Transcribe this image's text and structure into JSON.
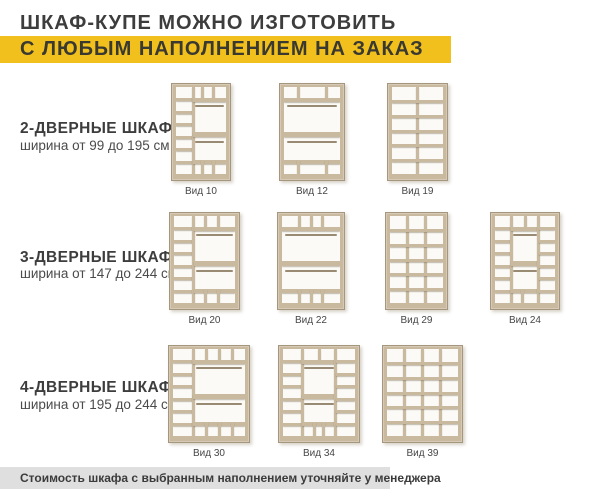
{
  "title": "ШКАФ-КУПЕ МОЖНО ИЗГОТОВИТЬ",
  "banner": "С ЛЮБЫМ НАПОЛНЕНИЕМ НА ЗАКАЗ",
  "footer": "Стоимость шкафа с выбранным наполнением уточняйте у менеджера",
  "colors": {
    "accent_yellow": "#f1c01d",
    "wood": "#c8b99f",
    "wood_edge": "#a5977e",
    "rod": "#998b73",
    "text_dark": "#3d3d3d",
    "footer_bg": "#dfdfdf"
  },
  "sections": [
    {
      "heading": "2-ДВЕРНЫЕ ШКАФЫ",
      "subheading": "ширина от 99 до 195 см",
      "layout": {
        "heading_top": 120,
        "sub_top": 138,
        "row_top": 83,
        "label_top": 186
      },
      "wardrobes": [
        {
          "label": "Вид 10",
          "x": 171,
          "width": 60,
          "columns": [
            {
              "width": 0.34,
              "type": "shelves",
              "shelves": 6
            },
            {
              "width": 0.66,
              "type": "hang",
              "top_dividers": [
                0.3,
                0.62
              ],
              "bottom_dividers": [
                0.3,
                0.62
              ],
              "mid_shelf": true
            }
          ]
        },
        {
          "label": "Вид 12",
          "x": 279,
          "width": 66,
          "columns": [
            {
              "width": 1,
              "type": "hang",
              "top_dividers": [
                0.25,
                0.75
              ],
              "bottom_dividers": [
                0.25,
                0.75
              ],
              "mid_shelf": true
            }
          ]
        },
        {
          "label": "Вид 19",
          "x": 387,
          "width": 61,
          "columns": [
            {
              "width": 1,
              "type": "grid",
              "grid_cols": 2,
              "grid_rows": 6
            }
          ]
        }
      ]
    },
    {
      "heading": "3-ДВЕРНЫЕ ШКАФЫ",
      "subheading": "ширина от 147 до 244 см",
      "layout": {
        "heading_top": 249,
        "sub_top": 266,
        "row_top": 212,
        "label_top": 315
      },
      "wardrobes": [
        {
          "label": "Вид 20",
          "x": 169,
          "width": 71,
          "columns": [
            {
              "width": 0.32,
              "type": "shelves",
              "shelves": 6
            },
            {
              "width": 0.68,
              "type": "hang",
              "top_dividers": [
                0.3,
                0.6
              ],
              "bottom_dividers": [
                0.3,
                0.6
              ],
              "mid_shelf": true
            }
          ]
        },
        {
          "label": "Вид 22",
          "x": 277,
          "width": 68,
          "columns": [
            {
              "width": 1,
              "type": "hang",
              "top_dividers": [
                0.3,
                0.5,
                0.7
              ],
              "bottom_dividers": [
                0.3,
                0.5,
                0.7
              ],
              "mid_shelf": true
            }
          ]
        },
        {
          "label": "Вид 29",
          "x": 385,
          "width": 63,
          "columns": [
            {
              "width": 1,
              "type": "grid",
              "grid_cols": 3,
              "grid_rows": 6
            }
          ]
        },
        {
          "label": "Вид 24",
          "x": 490,
          "width": 70,
          "columns": [
            {
              "width": 0.27,
              "type": "shelves",
              "shelves": 6
            },
            {
              "width": 0.46,
              "type": "hang",
              "top_dividers": [
                0.5
              ],
              "bottom_dividers": [
                0.4
              ],
              "mid_shelf": true
            },
            {
              "width": 0.27,
              "type": "shelves",
              "shelves": 6
            }
          ]
        }
      ]
    },
    {
      "heading": "4-ДВЕРНЫЕ ШКАФЫ",
      "subheading": "ширина от 195 до 244 см",
      "layout": {
        "heading_top": 379,
        "sub_top": 397,
        "row_top": 345,
        "label_top": 448
      },
      "wardrobes": [
        {
          "label": "Вид 30",
          "x": 168,
          "width": 82,
          "columns": [
            {
              "width": 0.28,
              "type": "shelves",
              "shelves": 6
            },
            {
              "width": 0.72,
              "type": "hang",
              "top_dividers": [
                0.25,
                0.5,
                0.75
              ],
              "bottom_dividers": [
                0.25,
                0.5,
                0.75
              ],
              "mid_shelf": true
            }
          ]
        },
        {
          "label": "Вид 34",
          "x": 278,
          "width": 82,
          "columns": [
            {
              "width": 0.27,
              "type": "shelves",
              "shelves": 6
            },
            {
              "width": 0.46,
              "type": "hang",
              "top_dividers": [
                0.5
              ],
              "bottom_dividers": [
                0.35,
                0.65
              ],
              "mid_shelf": true
            },
            {
              "width": 0.27,
              "type": "shelves",
              "shelves": 6
            }
          ]
        },
        {
          "label": "Вид 39",
          "x": 382,
          "width": 81,
          "columns": [
            {
              "width": 1,
              "type": "grid",
              "grid_cols": 4,
              "grid_rows": 6
            }
          ]
        }
      ]
    }
  ]
}
